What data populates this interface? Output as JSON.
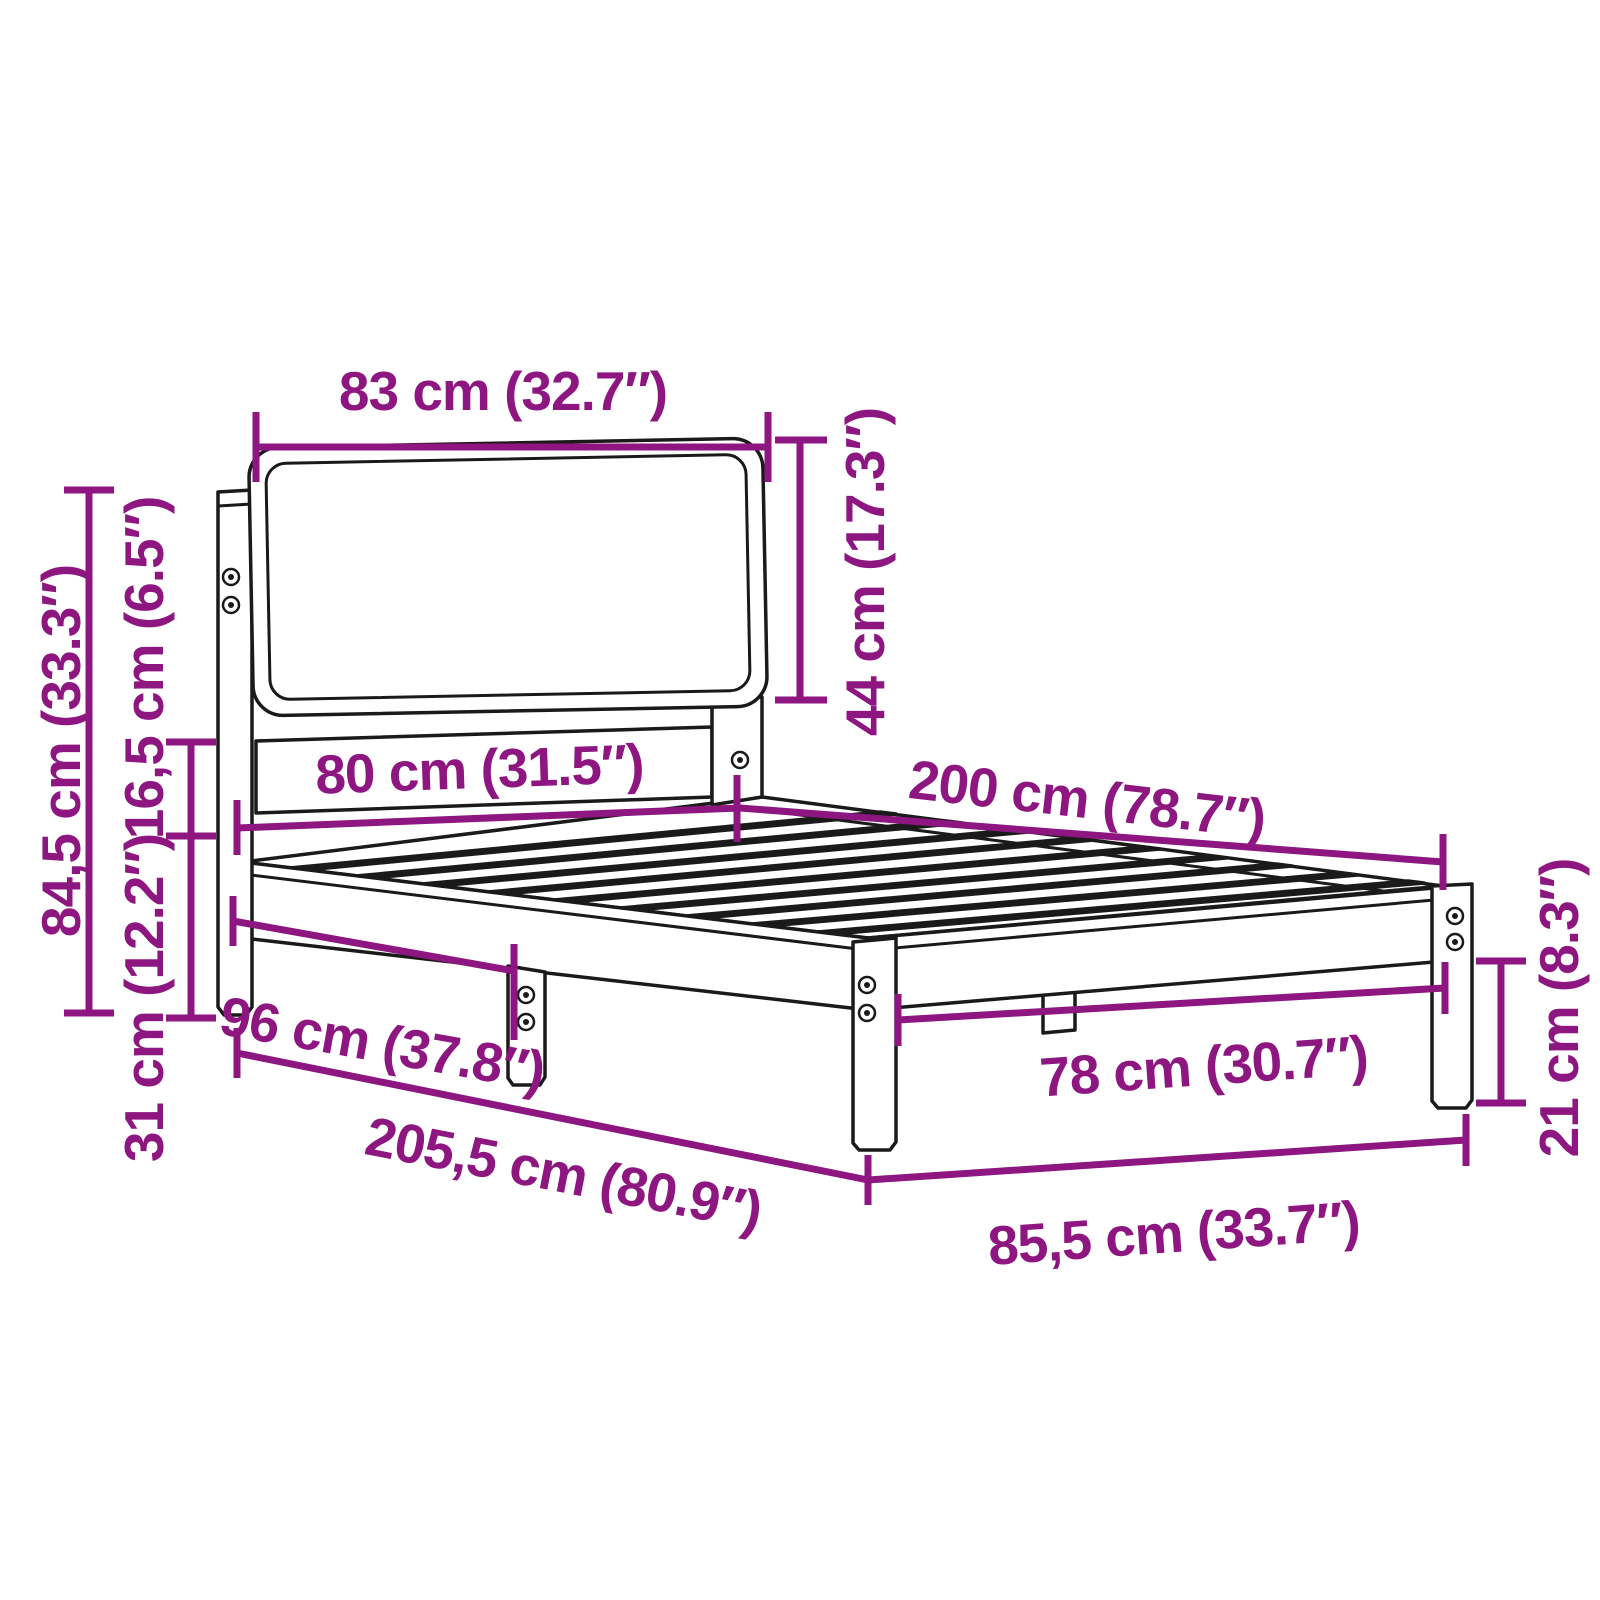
{
  "meta": {
    "title": "Bed frame dimension diagram",
    "product": "Bed frame with upholstered headboard and slatted base",
    "style": "technical line drawing with measurement callouts"
  },
  "colors": {
    "accent": "#8E1680",
    "outline": "#1A1A1A",
    "background": "#FFFFFF"
  },
  "dimensions": {
    "headboard_width": {
      "label": "83 cm (32.7″)",
      "cm": "83",
      "inches": "32.7"
    },
    "headboard_cushion_height": {
      "label": "44 cm (17.3″)",
      "cm": "44",
      "inches": "17.3"
    },
    "headboard_total_height": {
      "label": "84,5 cm (33.3″)",
      "cm": "84,5",
      "inches": "33.3"
    },
    "side_rail_height": {
      "label": "16,5 cm (6.5″)",
      "cm": "16,5",
      "inches": "6.5"
    },
    "under_bed_clearance": {
      "label": "31 cm (12.2″)",
      "cm": "31",
      "inches": "12.2"
    },
    "bed_width": {
      "label": "80 cm (31.5″)",
      "cm": "80",
      "inches": "31.5"
    },
    "bed_length": {
      "label": "200 cm (78.7″)",
      "cm": "200",
      "inches": "78.7"
    },
    "headboard_to_leg": {
      "label": "96 cm (37.8″)",
      "cm": "96",
      "inches": "37.8"
    },
    "total_length": {
      "label": "205,5 cm (80.9″)",
      "cm": "205,5",
      "inches": "80.9"
    },
    "foot_inner_width": {
      "label": "78 cm (30.7″)",
      "cm": "78",
      "inches": "30.7"
    },
    "total_width": {
      "label": "85,5 cm (33.7″)",
      "cm": "85,5",
      "inches": "33.7"
    },
    "leg_height": {
      "label": "21 cm (8.3″)",
      "cm": "21",
      "inches": "8.3"
    }
  }
}
